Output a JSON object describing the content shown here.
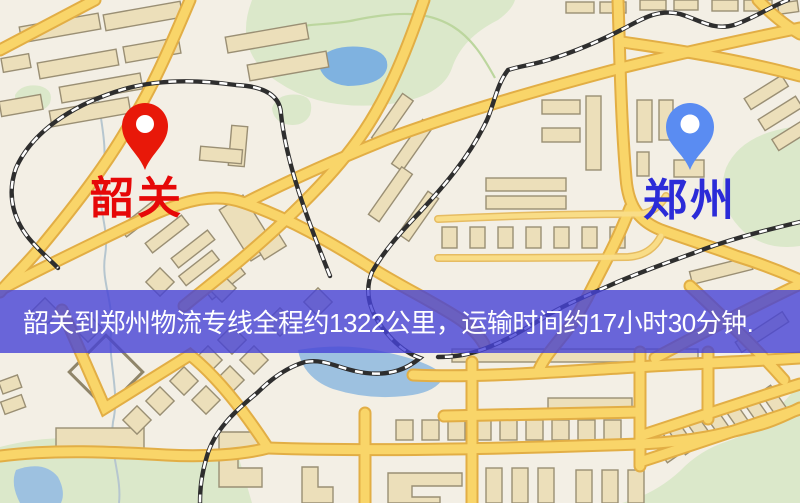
{
  "markers": {
    "origin": {
      "name": "韶关",
      "pin_color": "#e81809",
      "label_color": "#e60808"
    },
    "destination": {
      "name": "郑州",
      "pin_color": "#5a8cf2",
      "label_color": "#2b2bd8"
    }
  },
  "banner": {
    "text": "韶关到郑州物流专线全程约1322公里，运输时间约17小时30分钟.",
    "background": "#4642d6",
    "text_color": "#ffffff"
  },
  "map_colors": {
    "background": "#f3efe5",
    "road_fill": "#f9d569",
    "road_casing": "#e2ae45",
    "building": "#ecdfba",
    "park": "#dbe8ca",
    "water": "#7fb2e0",
    "railway": "#2e2e2e"
  }
}
